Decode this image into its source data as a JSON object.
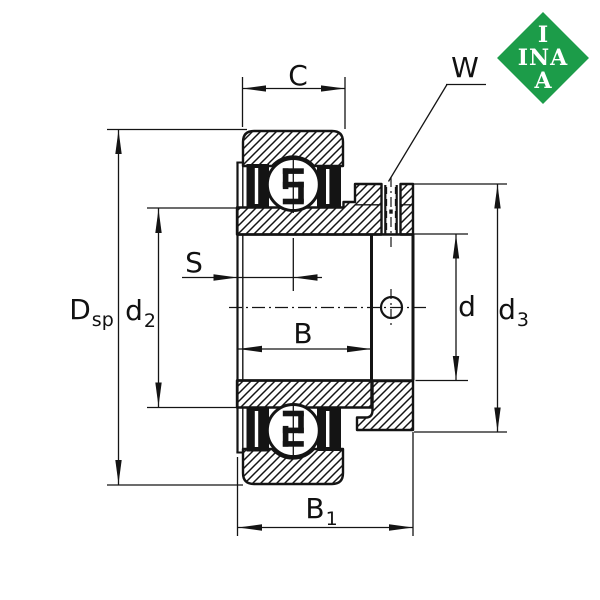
{
  "background_color": "#ffffff",
  "line_color": "#141414",
  "logo": {
    "color": "#1c9c49",
    "text_color": "#ffffff",
    "line1": "I",
    "line2": "INA",
    "line3": "A"
  },
  "labels": {
    "c": {
      "main": "C"
    },
    "w": {
      "main": "W"
    },
    "dsp": {
      "main": "D",
      "sub": "sp"
    },
    "d2": {
      "main": "d",
      "sub": "2"
    },
    "s": {
      "main": "S"
    },
    "b": {
      "main": "B"
    },
    "b1": {
      "main": "B",
      "sub": "1"
    },
    "d": {
      "main": "d"
    },
    "d3": {
      "main": "d",
      "sub": "3"
    }
  }
}
